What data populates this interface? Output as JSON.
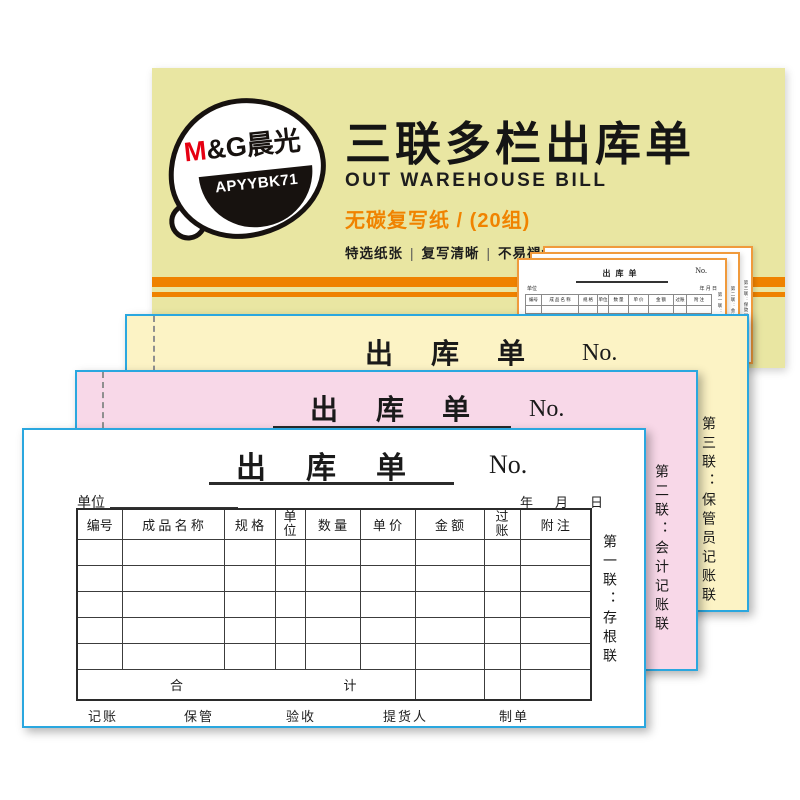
{
  "cover": {
    "brand": {
      "m": "M",
      "amp_g": "&G",
      "cn": "晨光"
    },
    "model": "APYYBK71",
    "title": "三联多栏出库单",
    "subtitle": "OUT WAREHOUSE BILL",
    "paper_spec": "无碳复写纸 / (20组)",
    "features": [
      "特选纸张",
      "复写清晰",
      "不易褪色",
      "长久保存"
    ],
    "separator": "|"
  },
  "form": {
    "title": "出库单",
    "no_label": "No.",
    "unit_label": "单位",
    "date_year": "年",
    "date_month": "月",
    "date_day": "日",
    "columns": [
      "编号",
      "成 品 名 称",
      "规 格",
      "单位",
      "数 量",
      "单 价",
      "金 额",
      "过账",
      "附 注"
    ],
    "total_left": "合",
    "total_right": "计",
    "signatures": [
      "记账",
      "保管",
      "验收",
      "提货人",
      "制单"
    ]
  },
  "sheets": {
    "first": {
      "copy_label": "第一联：存根联"
    },
    "second": {
      "copy_label": "第二联：会计记账联"
    },
    "third": {
      "copy_label": "第三联：保管员记账联"
    }
  },
  "colors": {
    "cover_bg": "#e9e6a2",
    "stripe_orange": "#ef8200",
    "sheet_yellow": "#fcf3c5",
    "sheet_pink": "#f8d8e8",
    "border_blue": "#2aa7df",
    "accent_orange": "#f08300",
    "brand_red": "#e60012",
    "thumb_border": "#f09a3c"
  }
}
